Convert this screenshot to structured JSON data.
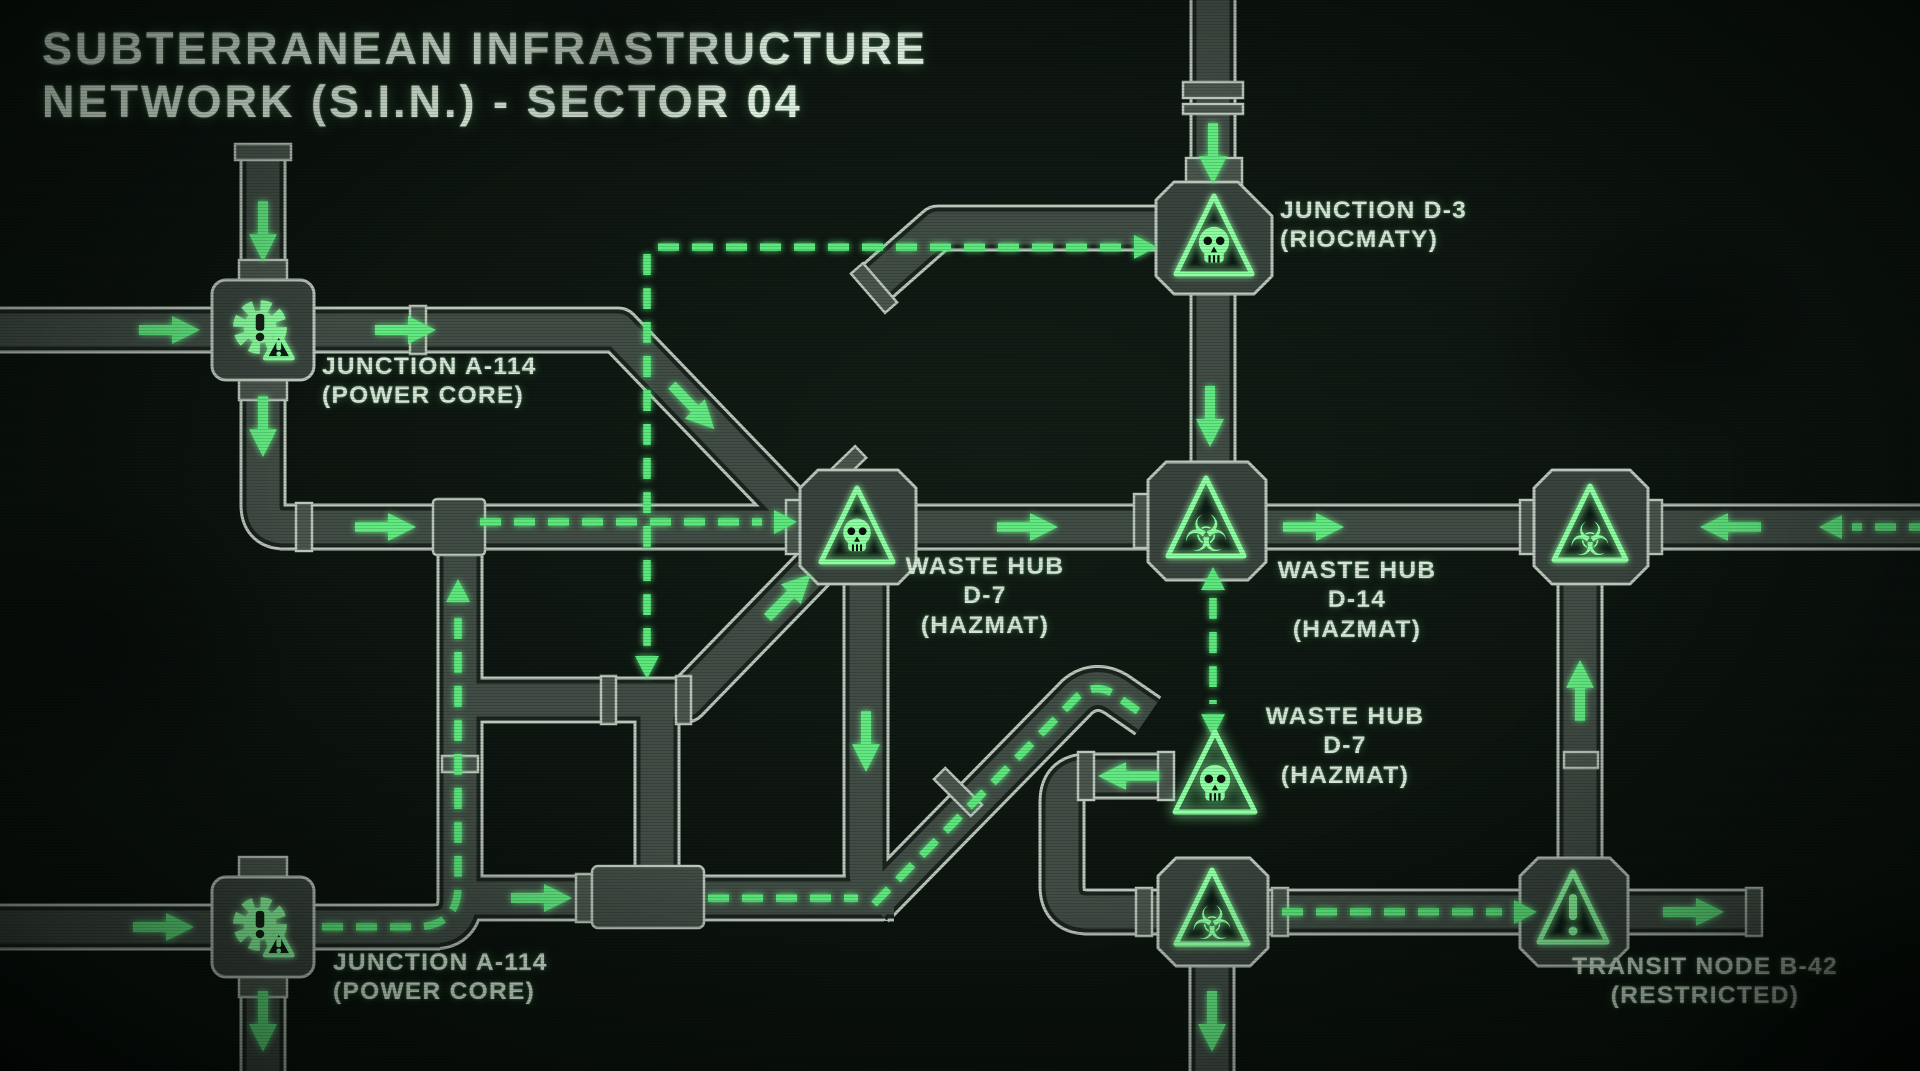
{
  "title": {
    "line1": "SUBTERRANEAN INFRASTRUCTURE",
    "line2": "NETWORK (S.I.N.) - SECTOR 04"
  },
  "labels": {
    "junction_a114_top": {
      "line1": "JUNCTION A-114",
      "line2": "(POWER CORE)",
      "icon": "gear-alert-icon"
    },
    "junction_d3": {
      "line1": "JUNCTION D-3",
      "line2": "(RIOCMATY)",
      "icon": "skull-triangle-icon"
    },
    "waste_hub_d7": {
      "line1": "WASTE HUB",
      "line2": "D-7",
      "line3": "(HAZMAT)",
      "icon": "skull-triangle-icon"
    },
    "waste_hub_d14": {
      "line1": "WASTE HUB",
      "line2": "D-14",
      "line3": "(HAZMAT)",
      "icon": "biohazard-triangle-icon"
    },
    "waste_hub_d7_lower": {
      "line1": "WASTE HUB",
      "line2": "D-7",
      "line3": "(HAZMAT)",
      "icon": "skull-triangle-icon"
    },
    "junction_a114_bottom": {
      "line1": "JUNCTION A-114",
      "line2": "(POWER CORE)",
      "icon": "gear-alert-icon"
    },
    "transit_b42": {
      "line1": "TRANSIT NODE B-42",
      "line2": "(RESTRICTED)",
      "icon": "warning-triangle-icon"
    }
  },
  "colors": {
    "background": "#0b130e",
    "pipe_outline": "#b9c6ba",
    "pipe_dark": "#1c241f",
    "pipe_fill": "#414c45",
    "flange_fill": "#4a554d",
    "housing_fill": "#3a443e",
    "flow_green": "#5ce87d",
    "arrow_green": "#62e981",
    "icon_green": "#8dffa2",
    "label_text": "#d6e5d5",
    "title_text": "#deeede"
  }
}
